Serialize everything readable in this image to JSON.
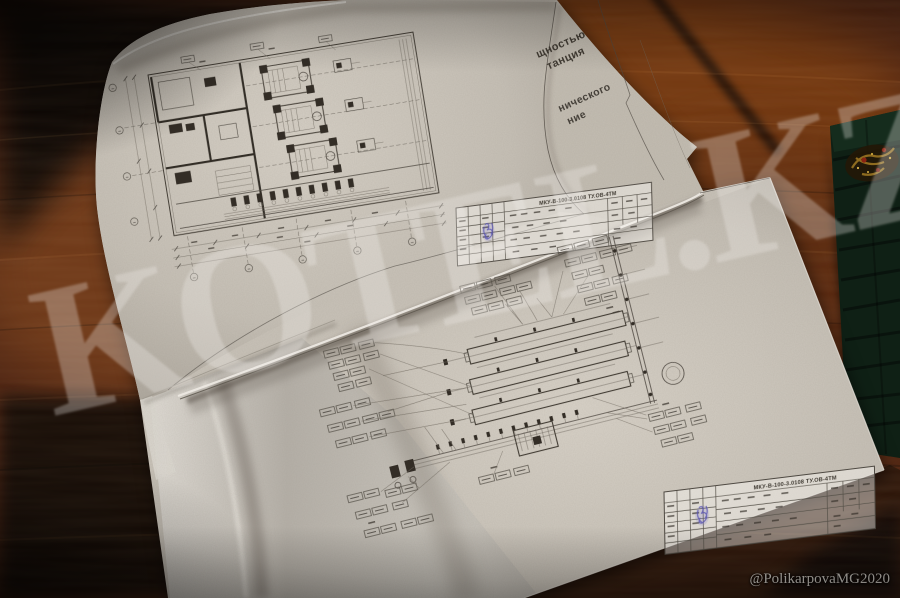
{
  "photo": {
    "watermark": {
      "site": "KOTEL.KZ",
      "credit": "@PolikarpovaMG2020"
    },
    "palette": {
      "wood": "#4a2110",
      "wood_highlight": "#7a3b16",
      "wood_shadow": "#120a05",
      "paper": "#c8c2b8",
      "ink": "#45403a",
      "stamp_blue": "#5753b2",
      "folder_green": "#0f2015",
      "emblem_gold": "#9a7422"
    }
  },
  "sheets": {
    "under_sheet_fragments": {
      "f1_line1": "щностью",
      "f1_line2": "танция",
      "f2_line1": "нического",
      "f2_line2": "ние"
    },
    "title_block": {
      "doc_number": "МКУ-В-100-3.0108 ТУ.ОВ-4ТМ"
    }
  }
}
